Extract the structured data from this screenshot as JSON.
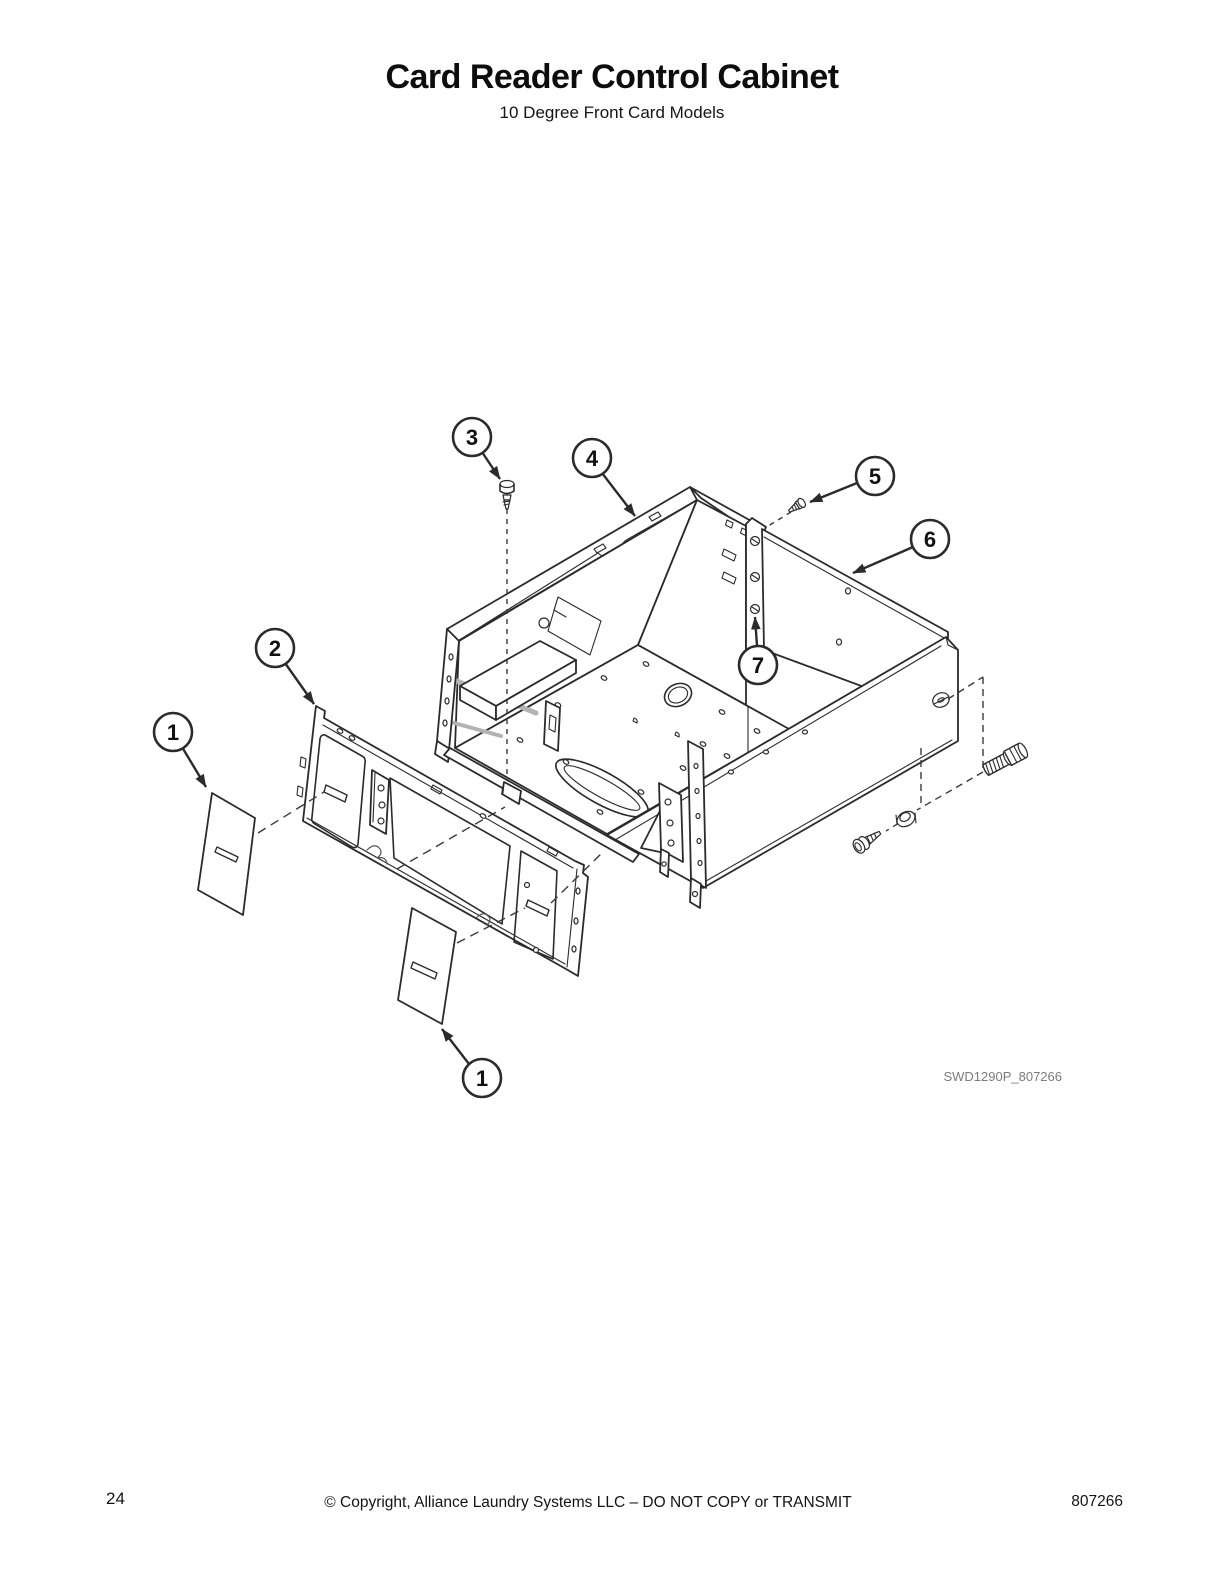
{
  "page": {
    "title": "Card Reader Control Cabinet",
    "subtitle": "10 Degree Front Card Models",
    "figure_id": "SWD1290P_807266",
    "footer": {
      "page_number": "24",
      "copyright": "© Copyright, Alliance Laundry Systems LLC – DO NOT COPY or TRANSMIT",
      "document_number": "807266"
    }
  },
  "diagram": {
    "type": "exploded-parts-diagram",
    "callouts": {
      "c1_top": "1",
      "c2": "2",
      "c3": "3",
      "c4": "4",
      "c5": "5",
      "c6": "6",
      "c7": "7",
      "c1_bottom": "1"
    },
    "colors": {
      "line": "#2b2b2b",
      "figure_id_text": "#7b7b7b",
      "shading": "#b3b3b3"
    }
  }
}
